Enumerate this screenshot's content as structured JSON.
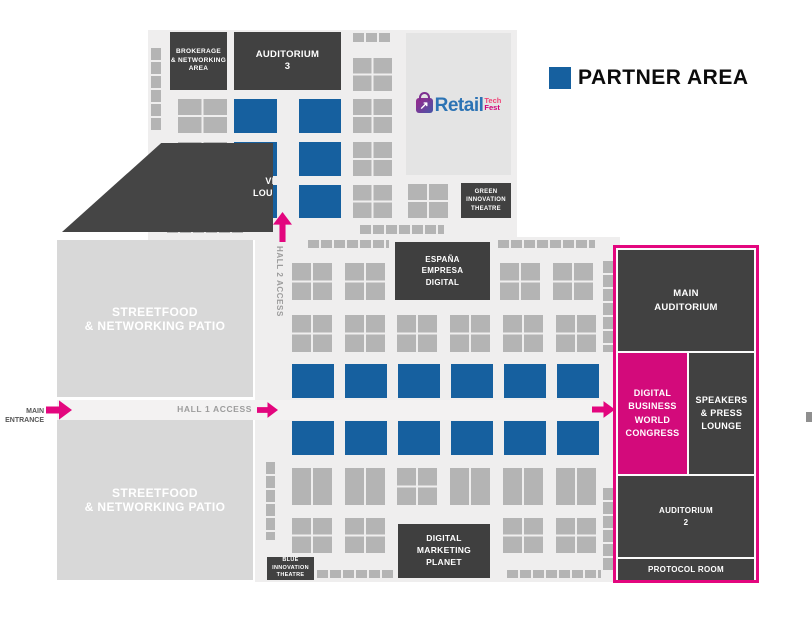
{
  "legend": {
    "label": "PARTNER AREA"
  },
  "logo": {
    "name": "Retail",
    "suffix_top": "Tech",
    "suffix_bottom": "Fest"
  },
  "hall2": {
    "brokerage": "BROKERAGE\n& NETWORKING\nAREA",
    "auditorium3": "AUDITORIUM\n3",
    "green_theatre": "GREEN\nINNOVATION\nTHEATRE",
    "vip_lounge": "VIP\nLOUNGE",
    "access": "HALL 2 ACCESS"
  },
  "hall1": {
    "espana": "ESPAÑA\nEMPRESA\nDIGITAL",
    "access": "HALL 1 ACCESS",
    "main_entrance": "MAIN\nENTRANCE",
    "streetfood_top": "STREETFOOD\n& NETWORKING PATIO",
    "streetfood_bottom": "STREETFOOD\n& NETWORKING PATIO",
    "blue_theatre": "BLUE\nINNOVATION\nTHEATRE",
    "marketing_planet": "DIGITAL\nMARKETING\nPLANET"
  },
  "congress_area": {
    "main_auditorium": "MAIN\nAUDITORIUM",
    "congress": "DIGITAL\nBUSINESS\nWORLD\nCONGRESS",
    "speakers": "SPEAKERS\n& PRESS\nLOUNGE",
    "auditorium2": "AUDITORIUM\n2",
    "protocol": "PROTOCOL ROOM"
  },
  "colors": {
    "partner_blue": "#16609f",
    "access_magenta": "#e3067e",
    "congress_pink": "#d30a7b",
    "dark_block": "#414141",
    "booth_gray": "#b4b4b4",
    "hall_bg": "#efeeee",
    "streetfood_gray": "#d8d8d8",
    "logo_blue": "#2c73b4",
    "logo_tech_pink": "#ef4478",
    "logo_fest_magenta": "#cf0079"
  }
}
